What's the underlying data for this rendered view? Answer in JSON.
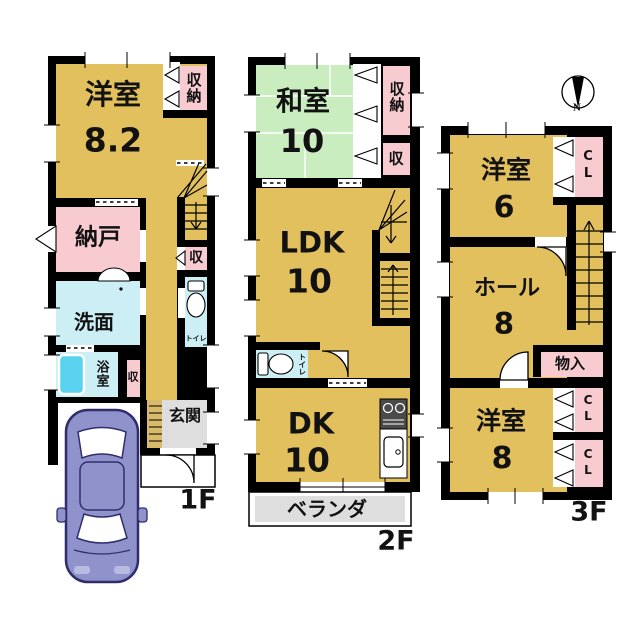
{
  "palette": {
    "room_tan": "#E2C05E",
    "closet_pink": "#F7CBD0",
    "tatami_green": "#C9EDBF",
    "wet_blue": "#CBEFF4",
    "bathtub_blue": "#58D2EE",
    "entrance_gray": "#DEDEDE",
    "balcony_gray": "#DEDEDE",
    "step_tan": "#D9B96A",
    "wall_black": "#000000",
    "car_purple": "#9092CC"
  },
  "compass": {
    "north_label": "N"
  },
  "floors": {
    "f1": {
      "floor_label": "1F",
      "rooms": {
        "yoshitsu": {
          "name": "洋室",
          "size": "8.2"
        },
        "shuno": {
          "name": "収納"
        },
        "nando": {
          "name": "納戸"
        },
        "senmen": {
          "name": "洗面"
        },
        "yokushitsu": {
          "name": "浴室"
        },
        "shu_bath": {
          "name": "収"
        },
        "shu_hall": {
          "name": "収"
        },
        "toilet": {
          "name": "トイレ"
        },
        "genkan": {
          "name": "玄関"
        }
      }
    },
    "f2": {
      "floor_label": "2F",
      "rooms": {
        "washitsu": {
          "name": "和室",
          "size": "10"
        },
        "shuno": {
          "name": "収納"
        },
        "shu": {
          "name": "収"
        },
        "ldk": {
          "name": "LDK",
          "size": "10"
        },
        "toilet": {
          "name": "トイレ"
        },
        "dk": {
          "name": "DK",
          "size": "10"
        },
        "veranda": {
          "name": "ベランダ"
        }
      }
    },
    "f3": {
      "floor_label": "3F",
      "rooms": {
        "yoshitsu6": {
          "name": "洋室",
          "size": "6"
        },
        "cl_top": {
          "name": "CL"
        },
        "hall": {
          "name": "ホール",
          "size": "8"
        },
        "monoire": {
          "name": "物入"
        },
        "yoshitsu8": {
          "name": "洋室",
          "size": "8"
        },
        "cl_mid": {
          "name": "CL"
        },
        "cl_bottom": {
          "name": "CL"
        }
      }
    }
  }
}
